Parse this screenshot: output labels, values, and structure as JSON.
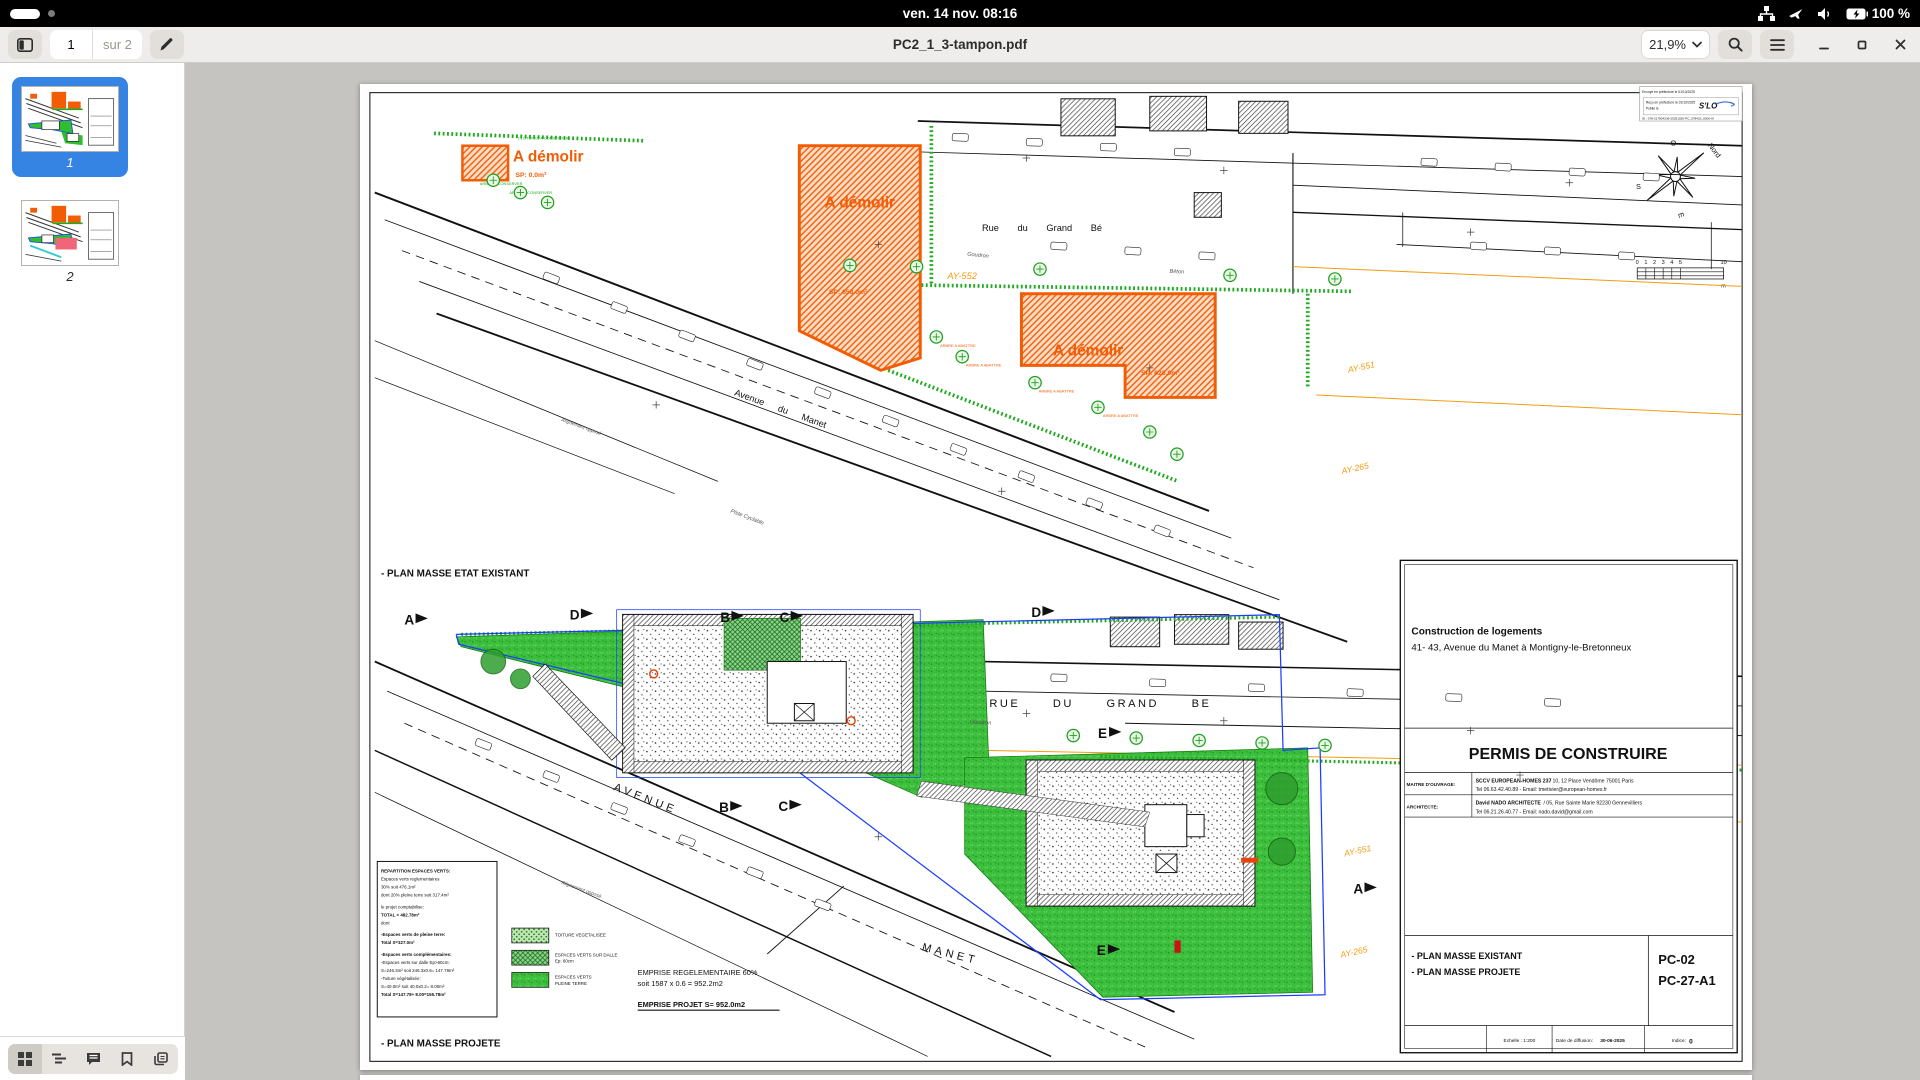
{
  "topbar": {
    "clock": "ven. 14 nov.  08:16",
    "battery": "100 %"
  },
  "header": {
    "page_current": "1",
    "page_total": "sur 2",
    "title": "PC2_1_3-tampon.pdf",
    "zoom": "21,9%"
  },
  "sidebar": {
    "thumb1": "1",
    "thumb2": "2"
  },
  "doc": {
    "stamp": {
      "l1": "Envoyé en préfecture le 01/10/2025",
      "l2": "Reçu en préfecture le 01/10/2025",
      "l3": "Publié le",
      "l4": "ID : 078-217804236-20251020-PC_078423_0006-AI",
      "logo": "S'LO"
    },
    "compass": {
      "o": "O",
      "nord": "Nord",
      "s": "S",
      "e": "E"
    },
    "scale": {
      "t0": "0",
      "t1": "1",
      "t2": "2",
      "t3": "3",
      "t4": "4",
      "t5": "5",
      "t10": "10",
      "unit": "m"
    },
    "plan1": {
      "caption": "- PLAN MASSE ETAT EXISTANT",
      "dem1": "A démolir",
      "dem1_sp": "SP: 0.0m²",
      "dem2": "A démolir",
      "dem2_sp": "SP: 658.0m²",
      "dem3": "A démolir",
      "dem3_sp": "SP: 625.0m²",
      "rue": "Rue du Grand Bé",
      "avenue": "Avenue du Manet",
      "alignement": "Alignement opposé",
      "goudron": "Goudron",
      "beton": "Béton",
      "piste": "Piste Cyclable",
      "ay552": "AY-552",
      "ay551": "AY-551",
      "ay265": "AY-265",
      "clotures": "CLOTURES A CONSERVER",
      "arbre_c": "ARBRE A CONSERVER",
      "arbre_a": "ARBRE A ABATTRE"
    },
    "plan2": {
      "caption": "- PLAN MASSE PROJETE",
      "rue": "RUE DU GRAND BE",
      "avenue": "AVENUE",
      "manet": "MANET",
      "alignement": "Alignement opposé",
      "goudron": "Goudron",
      "ay551": "AY-551",
      "ay265": "AY-265",
      "markers": [
        "A",
        "D",
        "B",
        "C",
        "D",
        "E",
        "B",
        "C",
        "E",
        "A"
      ],
      "legend": [
        "REPARTITION ESPACES VERTS:",
        "Espaces verts reglementaires",
        "30% soit 476.1m²",
        "dont 20% pleine terre soit 317.4m²",
        "le projet comptabilise:",
        "TOTAL = 482.78m²",
        "dont",
        "-Espaces verts de pleine terre:",
        "Total S=327.0m²",
        "-Espaces verts complémentaires:",
        "-Espaces verts sur dalle Ep>60cm:",
        "S=246.3m² soit 246.3x0.6= 147.78m²",
        "-Toiture végétalisée:",
        "S=40.0m² soit 40.0x0.2= 8.00m²",
        "Total S=147.78+ 8.00=155.78m²"
      ],
      "sw1": "TOITURE VEGETALISEE",
      "sw2": "ESPACES VERTS SUR DALLE",
      "sw2b": "Ep: 60cm",
      "sw3": "ESPACES VERTS",
      "sw3b": "PLEINE TERRE",
      "emp1": "EMPRISE REGELEMENTAIRE 60%",
      "emp2": "soit 1587 x 0.6 = 952.2m2",
      "emp3": "EMPRISE PROJET S= 952.0m2"
    },
    "titleblock": {
      "project": "Construction de logements",
      "address": "41- 43, Avenue du Manet à Montigny-le-Bretonneux",
      "permit": "PERMIS DE CONSTRUIRE",
      "mo_label": "MAITRE D'OUVRAGE:",
      "mo_name": "SCCV EUROPEAN-HOMES 237",
      "mo_rest": "/ 10, 12 Place Vendôme 75001 Paris",
      "mo_tel": "Tel 06.63.42.40.89 - Email: tmetivier@european-homes.fr",
      "ar_label": "ARCHITECTE:",
      "ar_name": "David NADO ARCHITECTE",
      "ar_rest": "/ 05, Rue Sainte Marie 92230 Gennevilliers",
      "ar_tel": "Tel 06.21.26.40.77 - Email: nado.david@gmail.com",
      "plans1": "- PLAN MASSE EXISTANT",
      "plans2": "- PLAN MASSE PROJETE",
      "sheet1": "PC-02",
      "sheet2": "PC-27-A1",
      "echelle": "Echelle : 1:200",
      "date_label": "Date de diffusion:",
      "date_value": "30-06-2025",
      "indice_label": "Indice:",
      "indice_value": "0"
    }
  }
}
